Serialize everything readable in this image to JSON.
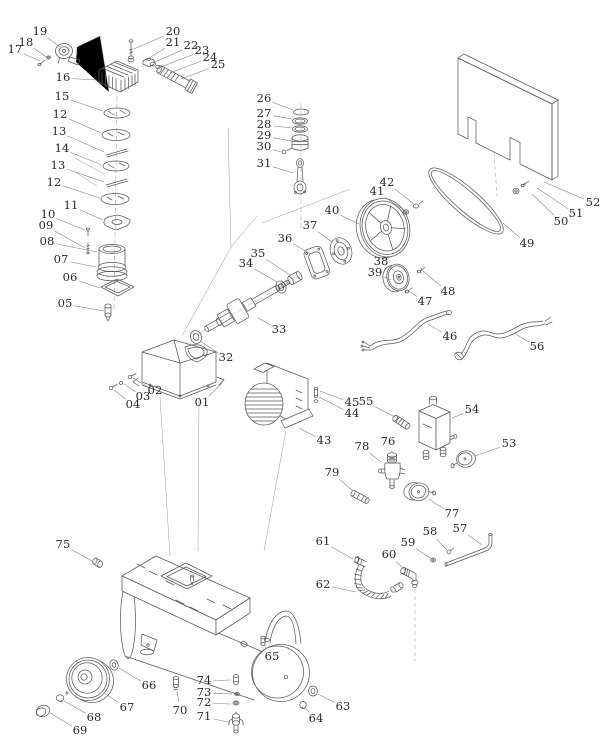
{
  "figure": {
    "width": 615,
    "height": 755,
    "background": "#ffffff",
    "line_color": "#5a5a5a",
    "leader_color": "#7d7d7d",
    "label_color": "#2a2a2a",
    "label_font_size": 11.5
  },
  "labels": [
    {
      "n": "17",
      "x": 15,
      "y": 50,
      "tx": 40,
      "ty": 61
    },
    {
      "n": "18",
      "x": 26,
      "y": 43,
      "tx": 48,
      "ty": 58
    },
    {
      "n": "19",
      "x": 40,
      "y": 32,
      "tx": 60,
      "ty": 47
    },
    {
      "n": "16",
      "x": 63,
      "y": 78,
      "tx": 97,
      "ty": 80
    },
    {
      "n": "20",
      "x": 173,
      "y": 32,
      "tx": 134,
      "ty": 49
    },
    {
      "n": "21",
      "x": 173,
      "y": 43,
      "tx": 146,
      "ty": 60
    },
    {
      "n": "22",
      "x": 191,
      "y": 46,
      "tx": 153,
      "ty": 63
    },
    {
      "n": "23",
      "x": 202,
      "y": 51,
      "tx": 161,
      "ty": 67
    },
    {
      "n": "24",
      "x": 210,
      "y": 58,
      "tx": 170,
      "ty": 73
    },
    {
      "n": "25",
      "x": 218,
      "y": 65,
      "tx": 181,
      "ty": 79
    },
    {
      "n": "15",
      "x": 62,
      "y": 97,
      "tx": 103,
      "ty": 111
    },
    {
      "n": "12",
      "x": 60,
      "y": 115,
      "tx": 101,
      "ty": 133
    },
    {
      "n": "13",
      "x": 59,
      "y": 132,
      "tx": 104,
      "ty": 152
    },
    {
      "n": "14",
      "x": 62,
      "y": 149,
      "tx": 102,
      "ty": 165
    },
    {
      "n": "13",
      "x": 58,
      "y": 166,
      "tx": 104,
      "ty": 182
    },
    {
      "n": "12",
      "x": 54,
      "y": 183,
      "tx": 100,
      "ty": 198
    },
    {
      "n": "11",
      "x": 71,
      "y": 206,
      "tx": 103,
      "ty": 220
    },
    {
      "n": "10",
      "x": 48,
      "y": 215,
      "tx": 85,
      "ty": 230
    },
    {
      "n": "09",
      "x": 46,
      "y": 226,
      "tx": 85,
      "ty": 248
    },
    {
      "n": "08",
      "x": 47,
      "y": 242,
      "tx": 97,
      "ty": 252
    },
    {
      "n": "07",
      "x": 61,
      "y": 260,
      "tx": 96,
      "ty": 267
    },
    {
      "n": "06",
      "x": 70,
      "y": 278,
      "tx": 100,
      "ty": 288
    },
    {
      "n": "05",
      "x": 65,
      "y": 304,
      "tx": 104,
      "ty": 311
    },
    {
      "n": "02",
      "x": 155,
      "y": 391,
      "tx": 133,
      "ty": 378
    },
    {
      "n": "03",
      "x": 143,
      "y": 397,
      "tx": 124,
      "ty": 384
    },
    {
      "n": "04",
      "x": 133,
      "y": 405,
      "tx": 114,
      "ty": 390
    },
    {
      "n": "01",
      "x": 202,
      "y": 403,
      "tx": 222,
      "ty": 383
    },
    {
      "n": "26",
      "x": 264,
      "y": 99,
      "tx": 293,
      "ty": 110
    },
    {
      "n": "27",
      "x": 264,
      "y": 114,
      "tx": 292,
      "ty": 119
    },
    {
      "n": "28",
      "x": 264,
      "y": 125,
      "tx": 292,
      "ty": 128
    },
    {
      "n": "29",
      "x": 264,
      "y": 136,
      "tx": 291,
      "ty": 141
    },
    {
      "n": "30",
      "x": 264,
      "y": 147,
      "tx": 281,
      "ty": 152
    },
    {
      "n": "31",
      "x": 264,
      "y": 164,
      "tx": 293,
      "ty": 173
    },
    {
      "n": "32",
      "x": 226,
      "y": 358,
      "tx": 200,
      "ty": 341
    },
    {
      "n": "33",
      "x": 279,
      "y": 330,
      "tx": 258,
      "ty": 318
    },
    {
      "n": "34",
      "x": 246,
      "y": 264,
      "tx": 277,
      "ty": 282
    },
    {
      "n": "35",
      "x": 258,
      "y": 254,
      "tx": 290,
      "ty": 275
    },
    {
      "n": "36",
      "x": 285,
      "y": 239,
      "tx": 311,
      "ty": 254
    },
    {
      "n": "37",
      "x": 310,
      "y": 226,
      "tx": 332,
      "ty": 242
    },
    {
      "n": "40",
      "x": 332,
      "y": 211,
      "tx": 359,
      "ty": 224
    },
    {
      "n": "41",
      "x": 377,
      "y": 192,
      "tx": 404,
      "ty": 210
    },
    {
      "n": "42",
      "x": 387,
      "y": 183,
      "tx": 414,
      "ty": 204
    },
    {
      "n": "38",
      "x": 381,
      "y": 262,
      "tx": 394,
      "ty": 270
    },
    {
      "n": "39",
      "x": 375,
      "y": 273,
      "tx": 391,
      "ty": 280
    },
    {
      "n": "47",
      "x": 425,
      "y": 302,
      "tx": 409,
      "ty": 291
    },
    {
      "n": "48",
      "x": 448,
      "y": 292,
      "tx": 423,
      "ty": 271
    },
    {
      "n": "46",
      "x": 450,
      "y": 337,
      "tx": 428,
      "ty": 324
    },
    {
      "n": "56",
      "x": 537,
      "y": 347,
      "tx": 514,
      "ty": 333
    },
    {
      "n": "49",
      "x": 527,
      "y": 244,
      "tx": 503,
      "ty": 223
    },
    {
      "n": "50",
      "x": 561,
      "y": 222,
      "tx": 532,
      "ty": 194
    },
    {
      "n": "51",
      "x": 576,
      "y": 214,
      "tx": 537,
      "ty": 188
    },
    {
      "n": "52",
      "x": 593,
      "y": 203,
      "tx": 544,
      "ty": 182
    },
    {
      "n": "43",
      "x": 324,
      "y": 441,
      "tx": 299,
      "ty": 428
    },
    {
      "n": "44",
      "x": 352,
      "y": 414,
      "tx": 319,
      "ty": 397
    },
    {
      "n": "45",
      "x": 352,
      "y": 403,
      "tx": 320,
      "ty": 391
    },
    {
      "n": "55",
      "x": 366,
      "y": 402,
      "tx": 395,
      "ty": 417
    },
    {
      "n": "54",
      "x": 472,
      "y": 410,
      "tx": 452,
      "ty": 418
    },
    {
      "n": "53",
      "x": 509,
      "y": 444,
      "tx": 475,
      "ty": 456
    },
    {
      "n": "76",
      "x": 388,
      "y": 442,
      "tx": 392,
      "ty": 452
    },
    {
      "n": "78",
      "x": 362,
      "y": 447,
      "tx": 381,
      "ty": 462
    },
    {
      "n": "79",
      "x": 332,
      "y": 473,
      "tx": 353,
      "ty": 491
    },
    {
      "n": "77",
      "x": 452,
      "y": 514,
      "tx": 429,
      "ty": 499
    },
    {
      "n": "57",
      "x": 460,
      "y": 529,
      "tx": 482,
      "ty": 545
    },
    {
      "n": "58",
      "x": 430,
      "y": 532,
      "tx": 447,
      "ty": 550
    },
    {
      "n": "59",
      "x": 408,
      "y": 543,
      "tx": 430,
      "ty": 558
    },
    {
      "n": "60",
      "x": 389,
      "y": 555,
      "tx": 405,
      "ty": 570
    },
    {
      "n": "61",
      "x": 323,
      "y": 542,
      "tx": 353,
      "ty": 559
    },
    {
      "n": "62",
      "x": 323,
      "y": 585,
      "tx": 356,
      "ty": 592
    },
    {
      "n": "63",
      "x": 343,
      "y": 707,
      "tx": 318,
      "ty": 694
    },
    {
      "n": "64",
      "x": 316,
      "y": 719,
      "tx": 306,
      "ty": 709
    },
    {
      "n": "65",
      "x": 272,
      "y": 657,
      "tx": 264,
      "ty": 645
    },
    {
      "n": "66",
      "x": 149,
      "y": 686,
      "tx": 119,
      "ty": 668
    },
    {
      "n": "67",
      "x": 127,
      "y": 708,
      "tx": 104,
      "ty": 693
    },
    {
      "n": "68",
      "x": 94,
      "y": 718,
      "tx": 64,
      "ty": 701
    },
    {
      "n": "69",
      "x": 80,
      "y": 731,
      "tx": 50,
      "ty": 713
    },
    {
      "n": "70",
      "x": 180,
      "y": 711,
      "tx": 177,
      "ty": 691
    },
    {
      "n": "71",
      "x": 204,
      "y": 717,
      "tx": 228,
      "ty": 722
    },
    {
      "n": "72",
      "x": 204,
      "y": 703,
      "tx": 231,
      "ty": 704
    },
    {
      "n": "73",
      "x": 204,
      "y": 693,
      "tx": 232,
      "ty": 694
    },
    {
      "n": "74",
      "x": 204,
      "y": 681,
      "tx": 231,
      "ty": 680
    },
    {
      "n": "75",
      "x": 63,
      "y": 545,
      "tx": 92,
      "ty": 561
    }
  ]
}
